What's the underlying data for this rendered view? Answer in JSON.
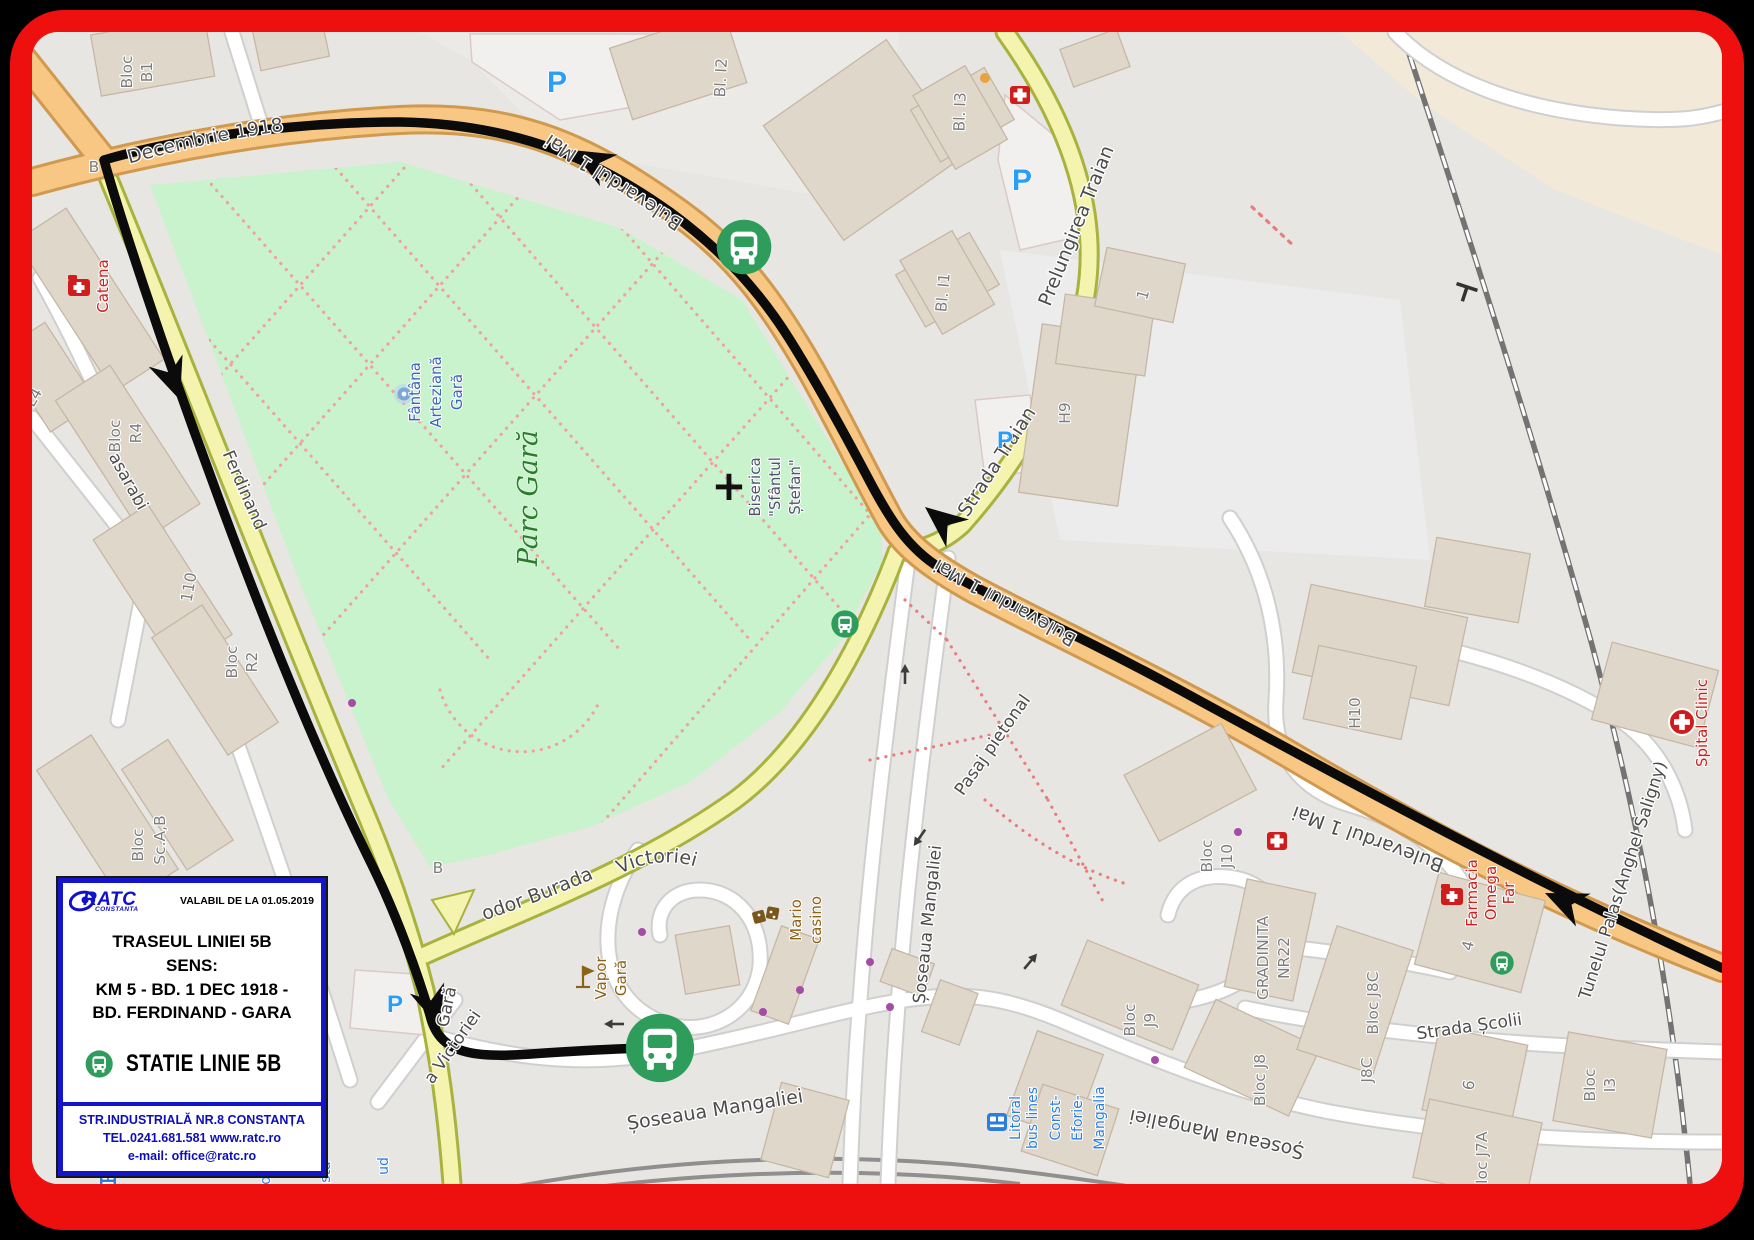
{
  "colors": {
    "frame_red": "#ee0f0f",
    "legend_blue": "#1414cc",
    "route_black": "#0b0b0b",
    "bus_green": "#2e9c5a",
    "park_green": "#c9f3cc",
    "road_orange": "#f7c783",
    "road_yellow": "#f4f4ae",
    "parking_blue": "#2a9df4"
  },
  "legend": {
    "logo_text": "RATC",
    "logo_sub": "CONSTANTA",
    "valid_from": "VALABIL DE LA 01.05.2019",
    "title": "TRASEUL LINIEI 5B",
    "sens": "SENS:",
    "route_line1": "KM 5   - BD. 1 DEC 1918  -",
    "route_line2": "BD. FERDINAND  - GARA",
    "station_label": "STATIE LINIE 5B",
    "address": "STR.INDUSTRIALĂ NR.8 CONSTANȚA",
    "phone_web": "TEL.0241.681.581   www.ratc.ro",
    "email": "e-mail: office@ratc.ro"
  },
  "map": {
    "streets": {
      "bd_1_dec": "Bulevardul 1 Decembrie 1918",
      "bd_1_mai": "Bulevardul 1 Mai",
      "prelungirea_traian": "Prelungirea Traian",
      "strada_traian": "Strada Traian",
      "bd_ferdinand": "Bulevardul Ferdinand",
      "strada_basarabi": "Strada Basarabi",
      "theodor_burada": "Strada Theodor Burada",
      "soseaua_mangaliei": "Șoseaua Mangaliei",
      "pasaj_pietonal": "Pasaj pietonal",
      "piata_victoriei": "Piața Victoriei",
      "a_victoriei": "a Victoriei",
      "strada_scolii": "Strada Școlii",
      "gara": "Gară",
      "tunelul": "Tunelul Palas(Anghel Saligny)",
      "b_stop": "B"
    },
    "pois": {
      "parc": "Parc Gară",
      "fantana": [
        "Fântâna",
        "Arteziană",
        "Gară"
      ],
      "biserica": [
        "Biserica",
        "\"Sfântul",
        "Ștefan\""
      ],
      "catena": "Catena",
      "vapor": [
        "Vapor",
        "Gară"
      ],
      "mario": [
        "Mario",
        "casino"
      ],
      "spital": "Spital Clinic",
      "farmacia": [
        "Farmacia",
        "Omega",
        "Far"
      ],
      "litoral": [
        "Litoral",
        "bus lines",
        "Const-",
        "Eforie-",
        "Mangalia"
      ],
      "fragments": [
        "og",
        "sta",
        "ud"
      ],
      "parking": "P"
    },
    "blocks": {
      "b1": [
        "Bloc",
        "B1"
      ],
      "i2": "Bl. I2",
      "i3": "Bl. I3",
      "i1": "Bl. I1",
      "l4": "L4",
      "r4": [
        "Bloc",
        "R4"
      ],
      "n110": "110",
      "r2": [
        "Bloc",
        "R2"
      ],
      "scab": [
        "Bloc",
        "Sc.A,B"
      ],
      "h9": "H9",
      "one": "1",
      "h10": "H10",
      "j10": [
        "Bloc",
        "J10"
      ],
      "gradinita": [
        "GRADINITA",
        "NR22"
      ],
      "j9": [
        "Bloc",
        "J9"
      ],
      "j8": "Bloc J8",
      "j8c": "Bloc J8C",
      "j8c_short": "J8C",
      "four": "4",
      "six": "6",
      "j7a": "Bloc J7A",
      "i3b": [
        "Bloc",
        "I3"
      ]
    }
  }
}
